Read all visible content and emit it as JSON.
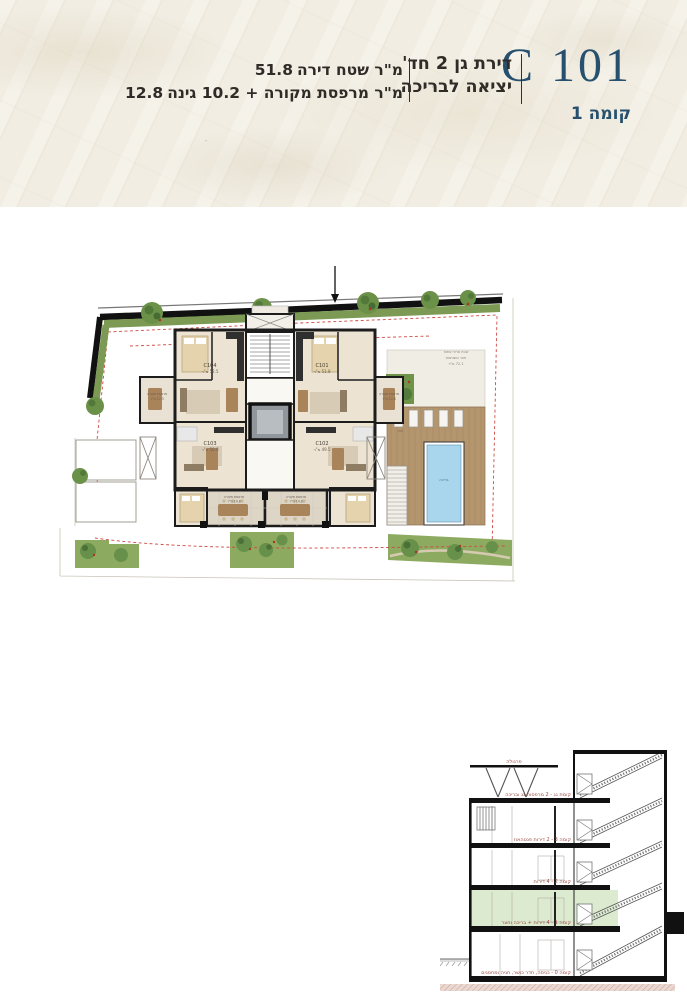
{
  "header": {
    "unit_code": "C 101",
    "floor_label": "קומה 1",
    "apartment_type_line1": "דירת גן 2 חד'",
    "apartment_type_line2": "יציאה לבריכה",
    "area_line1_value": "51.8",
    "area_line1_text": "מ\"ר שטח דירה",
    "area_line2_value": "12.8",
    "area_line2_text": "מ\"ר מרפסת מקורה + 10.2 גינה"
  },
  "plan": {
    "units": [
      {
        "code": "C104",
        "area": "52.5 מ\"ר"
      },
      {
        "code": "C101",
        "area": "51.8 מ\"ר"
      },
      {
        "code": "C103",
        "area": "50.0 מ\"ר"
      },
      {
        "code": "C102",
        "area": "49.5 מ\"ר"
      }
    ],
    "balcony_left_line1": "מרפסת מקורה",
    "balcony_left_line2": "12.3 מ\"ר",
    "balcony_right_line1": "מרפסת מקורה",
    "balcony_right_line2": "12.8 מ\"ר",
    "terrace_left_line1": "מרפסת מקורה",
    "terrace_left_line2": "14.8 מ\"ר",
    "terrace_right_line1": "מרפסת מקורה",
    "terrace_right_line2": "14.8 מ\"ר",
    "pool_label": "בריכה",
    "yard_label": "חצר",
    "site_note_line1": "שטח פרטי פתוח",
    "site_note_line2": "חצר משותפת",
    "site_note_line3": "72.1 מ\"ר"
  },
  "section": {
    "pergola_label": "פרגולה",
    "floor_labels": [
      "קומת גג - 2 מרפסות גג ובריכה",
      "קומה 3 - 2 דירות פנטהאוז",
      "קומה 2 - 4 דירות",
      "קומה 1 - 4 דירות + בריכה וחצר",
      "קומה 0 - כניסה, חדר כושר, חניה ומחסנים"
    ]
  },
  "colors": {
    "accent_navy": "#27506e",
    "label_red": "#9b4a42",
    "highlight_green": "#dcead0",
    "pool_blue": "#a9d6ec",
    "deck_wood": "#b4966e",
    "hedge_green": "#7d9a55",
    "paper": "#f1ede2"
  }
}
